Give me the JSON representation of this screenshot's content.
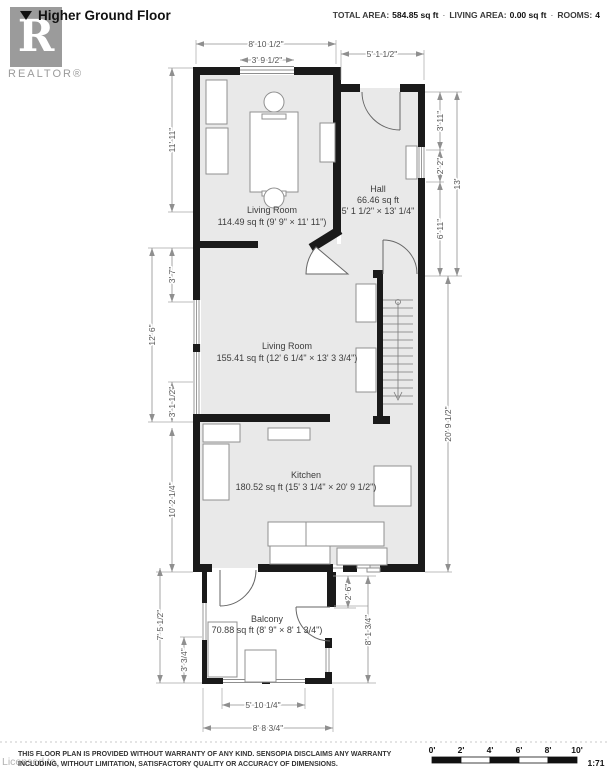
{
  "header": {
    "title": "Higher Ground Floor",
    "total_area_label": "TOTAL AREA:",
    "total_area_value": "584.85 sq ft",
    "sep1": "·",
    "living_area_label": "LIVING AREA:",
    "living_area_value": "0.00 sq ft",
    "sep2": "·",
    "rooms_label": "ROOMS:",
    "rooms_value": "4"
  },
  "logo": {
    "letter": "R",
    "wordmark": "REALTOR®"
  },
  "rooms": [
    {
      "lines": [
        "Living Room",
        "114.49 sq ft (9' 9\" × 11' 11\")"
      ]
    },
    {
      "lines": [
        "Hall",
        "66.46 sq ft",
        "5' 1 1/2\" × 13' 1/4\""
      ]
    },
    {
      "lines": [
        "Living Room",
        "155.41 sq ft (12' 6 1/4\" × 13' 3 3/4\")"
      ]
    },
    {
      "lines": [
        "Kitchen",
        "180.52 sq ft (15' 3 1/4\" × 20' 9 1/2\")"
      ]
    },
    {
      "lines": [
        "Balcony",
        "70.88 sq ft (8' 9\" × 8' 1 3/4\")"
      ]
    }
  ],
  "dims": {
    "top": [
      "8' 10 1/2\"",
      "3' 9 1/2\"",
      "5' 1 1/2\""
    ],
    "left": [
      "11' 11\"",
      "3' 7\"",
      "12' 6\"",
      "3' 1 1/2\"",
      "10' 2 1/4\"",
      "7' 5 1/2\"",
      "3' 3/4\""
    ],
    "right": [
      "3' 11\"",
      "2' 2\"",
      "6' 11\"",
      "13'",
      "20' 9 1/2\"",
      "2' 6\"",
      "8' 1 3/4\""
    ],
    "bottom": [
      "5' 10 1/4\"",
      "8' 8 3/4\""
    ]
  },
  "footer": {
    "disclaimer_line1": "THIS FLOOR PLAN IS PROVIDED WITHOUT WARRANTY OF ANY KIND. SENSOPIA DISCLAIMS ANY WARRANTY",
    "disclaimer_line2": "INCLUDING, WITHOUT LIMITATION, SATISFACTORY QUALITY OR ACCURACY OF DIMENSIONS.",
    "watermark": "Licensed to",
    "scale_labels": [
      "0'",
      "2'",
      "4'",
      "6'",
      "8'",
      "10'"
    ],
    "scale_ratio": "1:71"
  }
}
